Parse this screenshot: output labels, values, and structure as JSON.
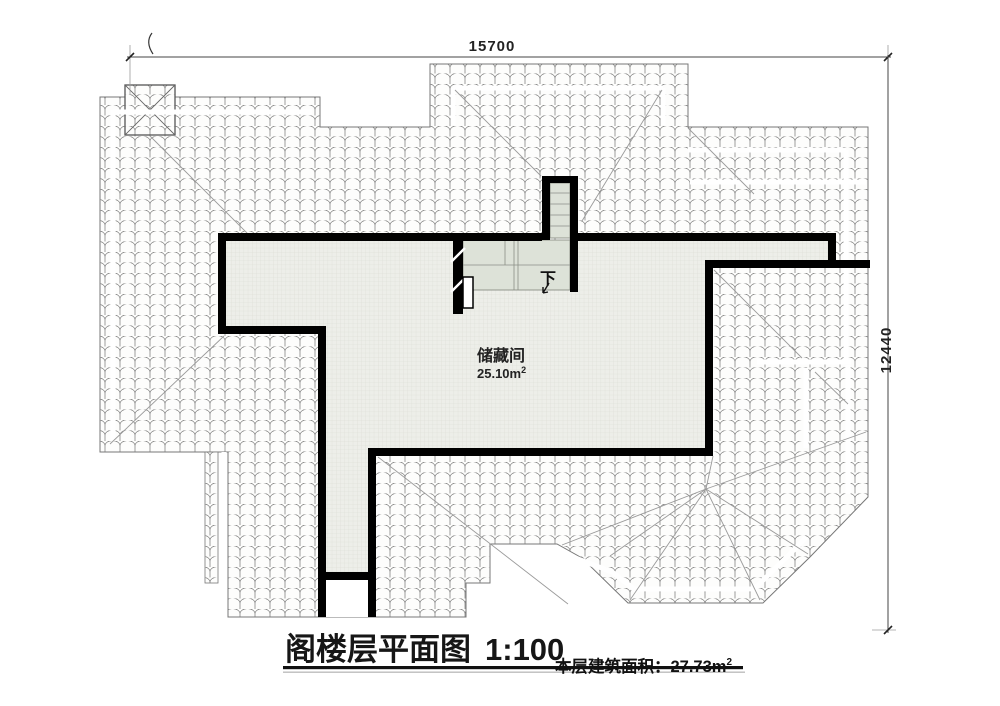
{
  "drawing": {
    "dimensions": {
      "top": "15700",
      "right": "12440"
    },
    "room": {
      "name": "储藏间",
      "area_value": "25.10m",
      "area_sup": "2"
    },
    "stairs": {
      "down_label": "下"
    },
    "title": {
      "text": "阁楼层平面图",
      "scale": "1:100"
    },
    "footer": {
      "label": "本层建筑面积：",
      "value": "27.73m",
      "sup": "2"
    },
    "colors": {
      "wall": "#000000",
      "floor_fill": "#edeee9",
      "floor_grid": "#d9dbd2",
      "stair_fill": "#dde2d8",
      "tile_line": "#7d7d7d",
      "hip_line": "#9a9a9a",
      "dim_line": "#444444"
    }
  }
}
